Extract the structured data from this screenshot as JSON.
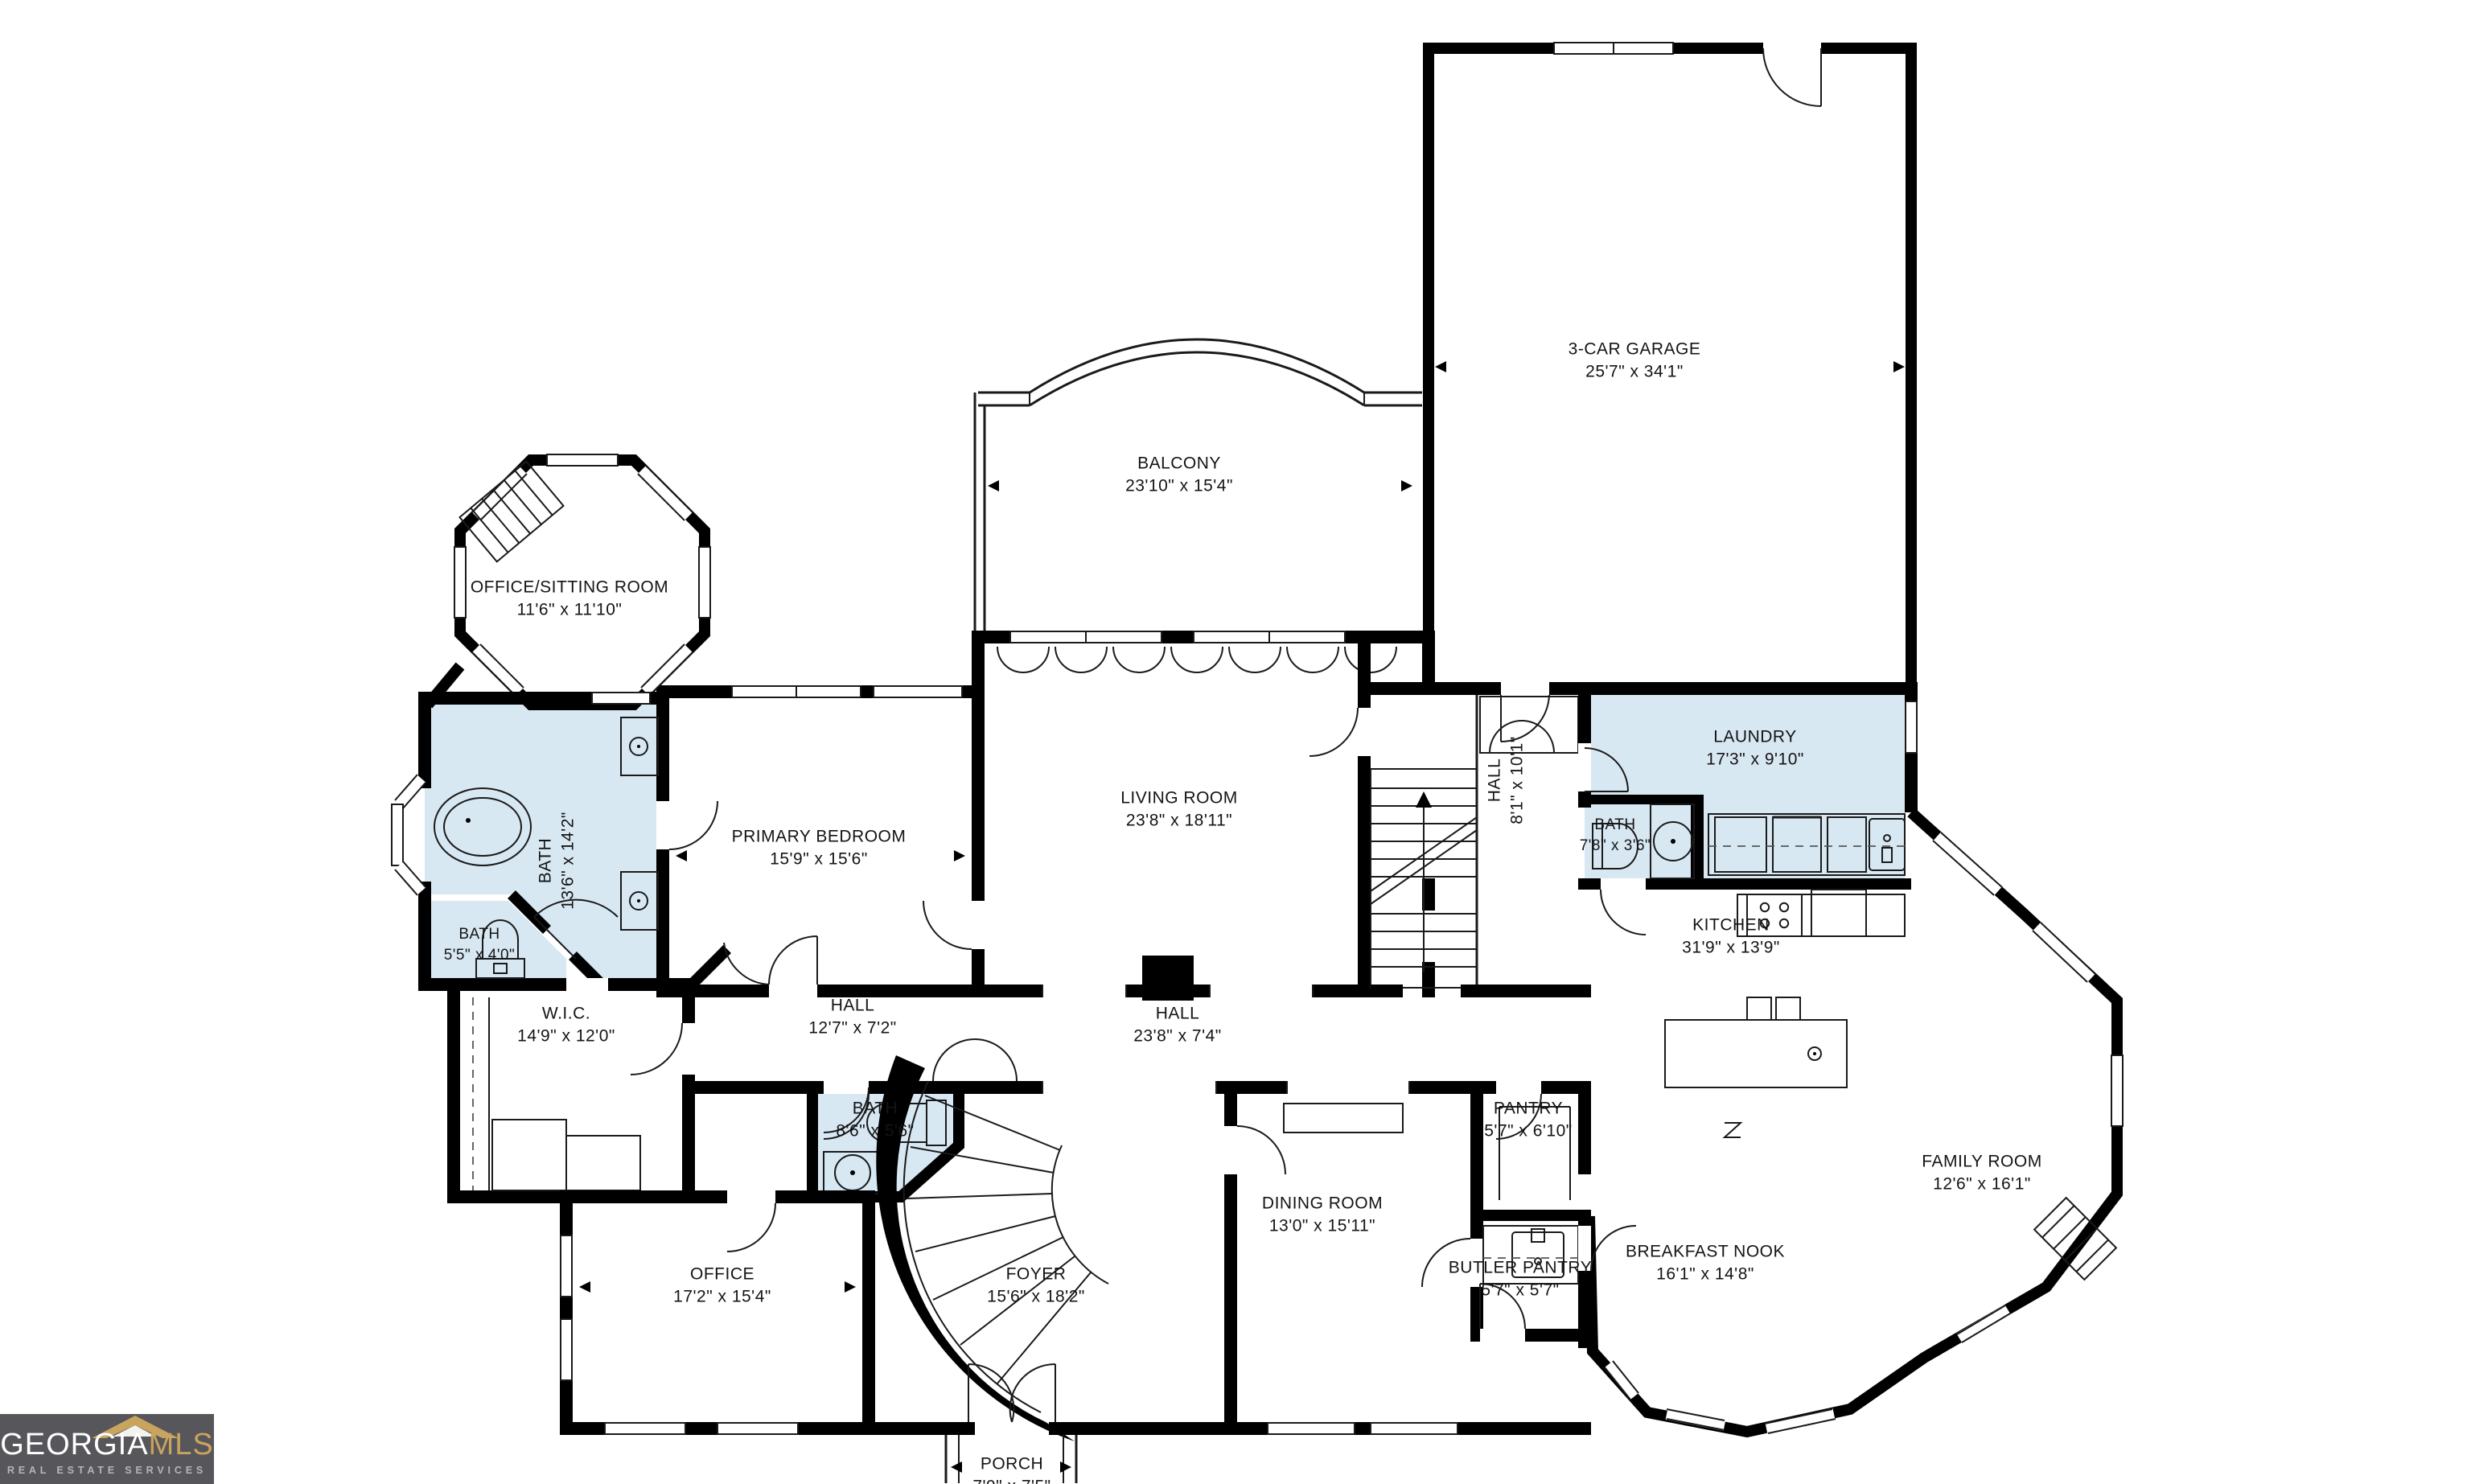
{
  "branding": {
    "brand_primary": "GEORGIA",
    "brand_secondary": "MLS",
    "tagline": "REAL ESTATE SERVICES",
    "brand_secondary_color": "#C9A45E",
    "logo_background": "#57565B"
  },
  "floorplan": {
    "wall_color": "#000000",
    "wet_room_color": "#D8E8F3",
    "background": "#FFFFFF",
    "rooms": [
      {
        "id": "office_sitting",
        "name": "OFFICE/SITTING ROOM",
        "dims": "11'6\" x 11'10\""
      },
      {
        "id": "balcony",
        "name": "BALCONY",
        "dims": "23'10\" x 15'4\""
      },
      {
        "id": "garage",
        "name": "3-CAR GARAGE",
        "dims": "25'7\" x 34'1\""
      },
      {
        "id": "primary_bath",
        "name": "BATH",
        "dims": "13'6\" x 14'2\""
      },
      {
        "id": "primary_bedroom",
        "name": "PRIMARY BEDROOM",
        "dims": "15'9\" x 15'6\""
      },
      {
        "id": "living_room",
        "name": "LIVING ROOM",
        "dims": "23'8\" x 18'11\""
      },
      {
        "id": "hall_stairs",
        "name": "HALL",
        "dims": "8'1\" x 10'1\""
      },
      {
        "id": "laundry",
        "name": "LAUNDRY",
        "dims": "17'3\" x 9'10\""
      },
      {
        "id": "bath_powder",
        "name": "BATH",
        "dims": "7'8\" x 3'6\""
      },
      {
        "id": "bath_small",
        "name": "BATH",
        "dims": "5'5\" x 4'0\""
      },
      {
        "id": "wic",
        "name": "W.I.C.",
        "dims": "14'9\" x 12'0\""
      },
      {
        "id": "hall_bedroom",
        "name": "HALL",
        "dims": "12'7\" x 7'2\""
      },
      {
        "id": "hall_main",
        "name": "HALL",
        "dims": "23'8\" x 7'4\""
      },
      {
        "id": "kitchen",
        "name": "KITCHEN",
        "dims": "31'9\" x 13'9\""
      },
      {
        "id": "bath_hall",
        "name": "BATH",
        "dims": "8'6\" x 5'6\""
      },
      {
        "id": "pantry",
        "name": "PANTRY",
        "dims": "5'7\" x 6'10\""
      },
      {
        "id": "dining",
        "name": "DINING ROOM",
        "dims": "13'0\" x 15'11\""
      },
      {
        "id": "butler",
        "name": "BUTLER PANTRY",
        "dims": "5'7\" x 5'7\""
      },
      {
        "id": "breakfast",
        "name": "BREAKFAST NOOK",
        "dims": "16'1\" x 14'8\""
      },
      {
        "id": "family",
        "name": "FAMILY ROOM",
        "dims": "12'6\" x 16'1\""
      },
      {
        "id": "office",
        "name": "OFFICE",
        "dims": "17'2\" x 15'4\""
      },
      {
        "id": "foyer",
        "name": "FOYER",
        "dims": "15'6\" x 18'2\""
      },
      {
        "id": "porch",
        "name": "PORCH",
        "dims": "7'9\" x 7'5\""
      }
    ]
  }
}
